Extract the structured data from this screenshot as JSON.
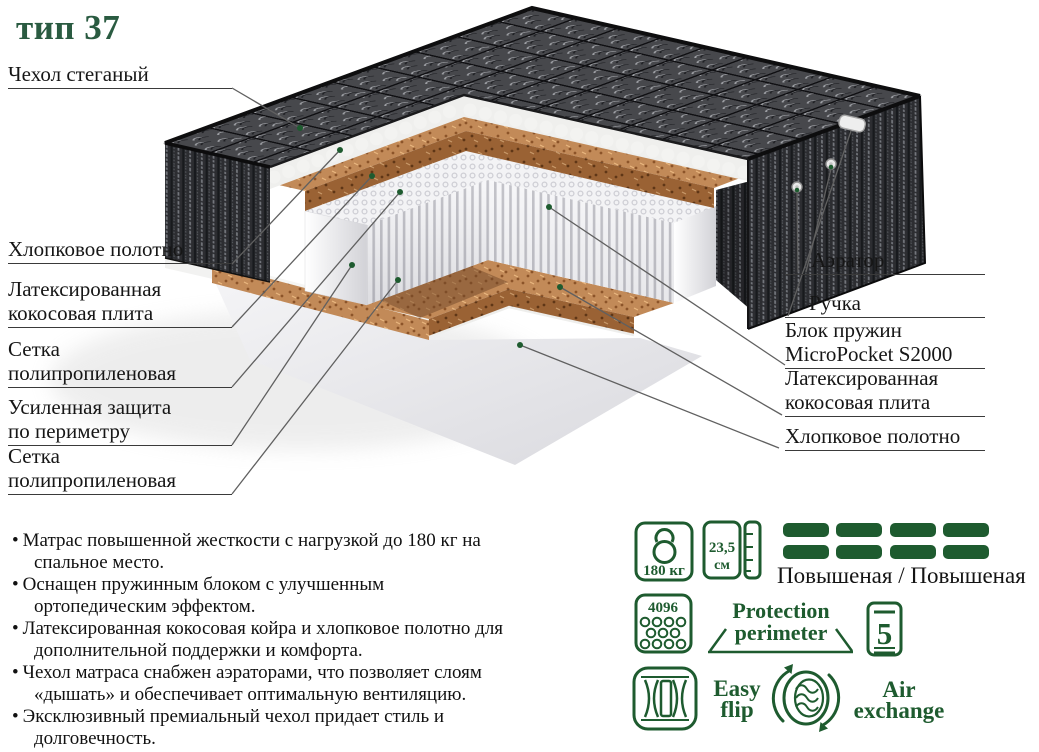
{
  "title": "тип 37",
  "colors": {
    "accent_green": "#1e5b2f",
    "title_green": "#2a5b41",
    "coir_brown": "#c28a58",
    "coir_dark": "#9a6234",
    "quilt_dark": "#47484c",
    "label_text": "#161616",
    "leader_gray": "#606060"
  },
  "diagram": {
    "labels_left": [
      "Чехол стеганый",
      "Хлопковое полотно",
      "Латексированная кокосовая плита",
      "Сетка полипропиленовая",
      "Усиленная защита по периметру",
      "Сетка полипропиленовая"
    ],
    "labels_right": [
      "Аэратор",
      "Ручка",
      "Блок пружин MicroPocket S2000",
      "Латексированная кокосовая плита",
      "Хлопковое полотно"
    ]
  },
  "bullets": [
    "Матрас повышенной жесткости с нагрузкой до 180 кг на спальное место.",
    "Оснащен пружинным блоком с улучшенным ортопедическим эффектом.",
    "Латексированная кокосовая койра и хлопковое полотно для дополнительной поддержки и комфорта.",
    "Чехол матраса снабжен аэраторами, что позволяет слоям «дышать» и обеспечивает оптимальную вентиляцию.",
    "Эксклюзивный премиальный чехол придает стиль и долговечность."
  ],
  "badges": {
    "max_load": "180 кг",
    "height_value": "23,5",
    "height_unit": "см",
    "springs_count": "4096",
    "firmness": "Повышеная / Повышеная",
    "protection_word1": "Protection",
    "protection_word2": "perimeter",
    "zones": "5",
    "flip_word1": "Easy",
    "flip_word2": "flip",
    "air_word1": "Air",
    "air_word2": "exchange"
  }
}
